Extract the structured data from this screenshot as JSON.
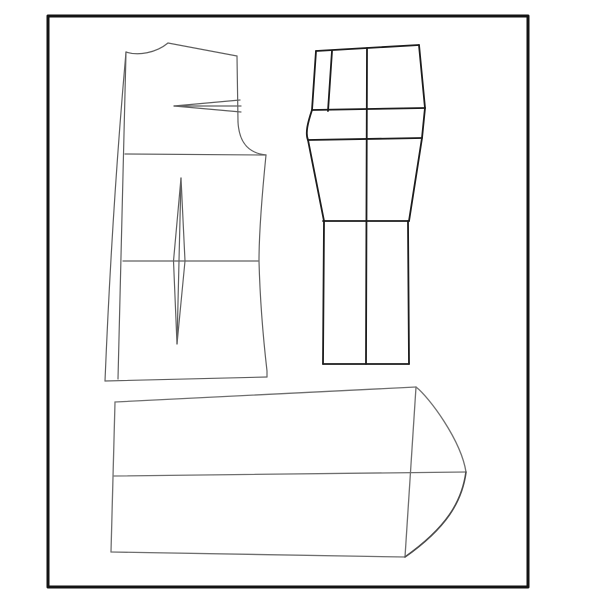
{
  "page": {
    "description": "Sewing pattern drafting diagram with three garment pattern pieces inside a black frame",
    "background_color": "#ffffff",
    "paper_color": "#fdfdfd"
  },
  "frame": {
    "x": 48,
    "y": 16,
    "width": 480,
    "height": 571,
    "stroke": "#121212",
    "stroke_width": 3
  },
  "canvas": {
    "width": 600,
    "height": 600
  },
  "pieces": [
    {
      "name": "bodice-front",
      "stroke": "#5f5f5f",
      "stroke_width": 1.2,
      "paths": [
        {
          "name": "center-front-outer-line",
          "d": "M126,52 Q112,210 105,381"
        },
        {
          "name": "center-front-inner-line",
          "d": "M126,52 L118,379"
        },
        {
          "name": "neckline-curve",
          "d": "M126,52 C138,56 156,53 168,43"
        },
        {
          "name": "shoulder-seam",
          "d": "M168,43 L237,56"
        },
        {
          "name": "armhole-upper-edge",
          "d": "M237,56 L238,122"
        },
        {
          "name": "armhole-curve",
          "d": "M238,122 C239,141 247,153 266,155"
        },
        {
          "name": "bust-panel-seam",
          "d": "M125,154 L266,155"
        },
        {
          "name": "side-seam",
          "d": "M266,155 C262,195 259,230 259,261 C260,300 264,345 267,371 L267,377"
        },
        {
          "name": "waist-line",
          "d": "M123,261 L258,261"
        },
        {
          "name": "hem-line",
          "d": "M105,381 L267,377"
        },
        {
          "name": "shoulder-dart-upper-leg",
          "d": "M174,106 L240,100"
        },
        {
          "name": "shoulder-dart-center-line",
          "d": "M174,106 L241,106"
        },
        {
          "name": "shoulder-dart-lower-leg",
          "d": "M174,106 L241,112"
        },
        {
          "name": "waist-dart-left-leg",
          "d": "M181,178 L173.5,261 L177,344"
        },
        {
          "name": "waist-dart-center-line",
          "d": "M181,178 L179,261 L177,344"
        },
        {
          "name": "waist-dart-right-leg",
          "d": "M181,178 L185,261 L177,344"
        }
      ]
    },
    {
      "name": "trouser-front",
      "stroke": "#1c1c1c",
      "stroke_width": 1.8,
      "paths": [
        {
          "name": "waist-edge",
          "d": "M316,51 L367,48 L419,45"
        },
        {
          "name": "side-seam-upper",
          "d": "M419,45 L425,108"
        },
        {
          "name": "side-seam-lower",
          "d": "M425,108 L422,138 L409,221"
        },
        {
          "name": "center-front-edge",
          "d": "M316,51 L312,110"
        },
        {
          "name": "fly-panel-line",
          "d": "M332,51 L328,111"
        },
        {
          "name": "hip-line",
          "d": "M312,110 L425,108"
        },
        {
          "name": "crotch-curve",
          "d": "M312,110 C308,122 305,133 308,140"
        },
        {
          "name": "crotch-line",
          "d": "M308,140 L422,138"
        },
        {
          "name": "inseam-upper",
          "d": "M308,140 L324,221"
        },
        {
          "name": "knee-line",
          "d": "M323,221 L409,221"
        },
        {
          "name": "leg-inseam-lower",
          "d": "M324,221 L323,364"
        },
        {
          "name": "leg-side-lower",
          "d": "M408,221 L409,364"
        },
        {
          "name": "hem-line",
          "d": "M323,364 L409,364"
        },
        {
          "name": "crease-line",
          "d": "M367,48 L366,364"
        }
      ]
    },
    {
      "name": "sleeve",
      "stroke": "#6e6e6e",
      "stroke_width": 1.3,
      "paths": [
        {
          "name": "top-edge",
          "d": "M115,402 L416,387"
        },
        {
          "name": "underarm-left-edge",
          "d": "M115,402 L111,552"
        },
        {
          "name": "bottom-edge",
          "d": "M111,552 L405,557"
        },
        {
          "name": "bicep-line",
          "d": "M416,387 L405,557"
        },
        {
          "name": "center-fold-line",
          "d": "M114,476 L466,472"
        },
        {
          "name": "cap-curve-upper",
          "d": "M416,387 C429,397 461,440 466,472"
        },
        {
          "name": "cap-curve-lower",
          "d": "M466,472 C462,502 446,528 405,557",
          "stroke": "#4a4a4a",
          "stroke_width": 1.6
        }
      ]
    }
  ]
}
